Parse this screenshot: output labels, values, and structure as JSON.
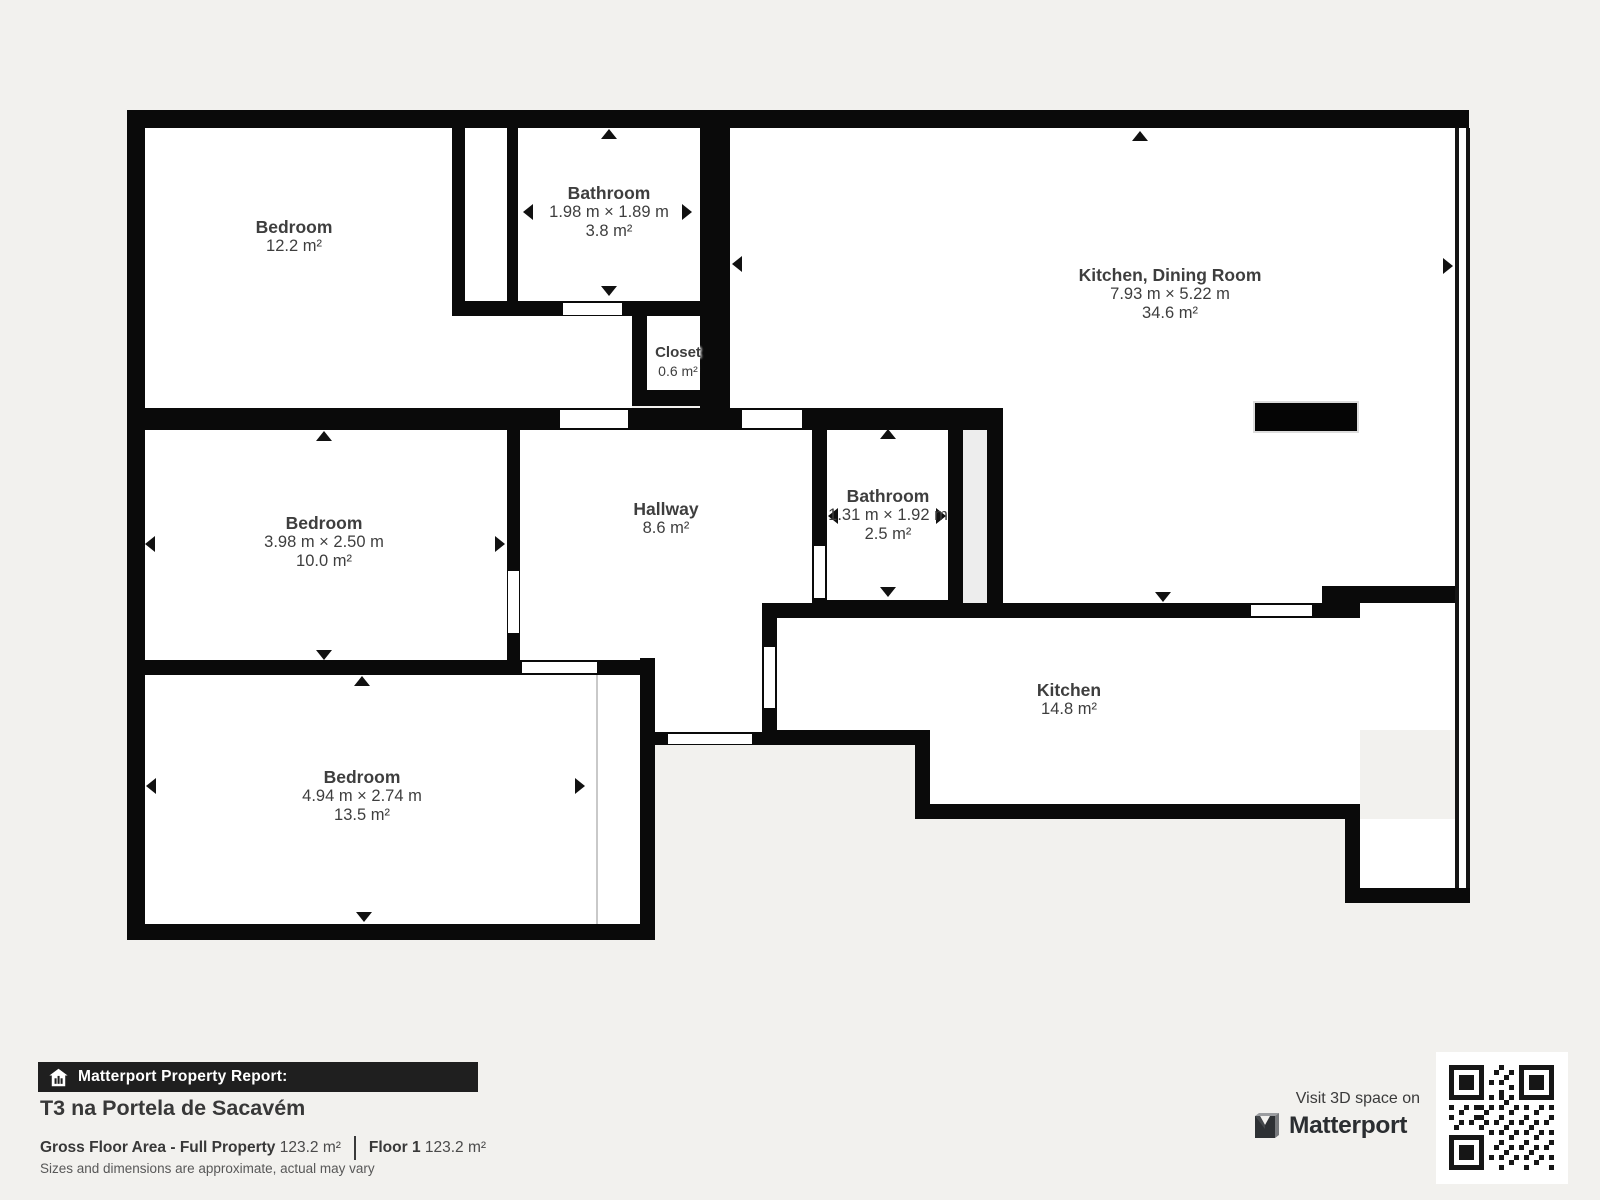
{
  "palette": {
    "background": "#f2f1ee",
    "wall": "#0a0a0a",
    "room_fill": "#ffffff",
    "label_text": "#3e3e3e",
    "bar_bg": "#1f1f1f",
    "brand_text": "#2b2e31"
  },
  "rooms": [
    {
      "id": "bedroom-top-left",
      "name": "Bedroom",
      "dims": "",
      "area": "12.2 m²"
    },
    {
      "id": "bathroom-top",
      "name": "Bathroom",
      "dims": "1.98 m × 1.89 m",
      "area": "3.8 m²"
    },
    {
      "id": "kitchen-dining",
      "name": "Kitchen, Dining Room",
      "dims": "7.93 m × 5.22 m",
      "area": "34.6 m²"
    },
    {
      "id": "closet",
      "name": "Closet",
      "dims": "",
      "area": "0.6 m²"
    },
    {
      "id": "bedroom-middle",
      "name": "Bedroom",
      "dims": "3.98 m × 2.50 m",
      "area": "10.0 m²"
    },
    {
      "id": "hallway",
      "name": "Hallway",
      "dims": "",
      "area": "8.6 m²"
    },
    {
      "id": "bathroom-middle",
      "name": "Bathroom",
      "dims": "1.31 m × 1.92 m",
      "area": "2.5 m²"
    },
    {
      "id": "kitchen",
      "name": "Kitchen",
      "dims": "",
      "area": "14.8 m²"
    },
    {
      "id": "bedroom-bottom",
      "name": "Bedroom",
      "dims": "4.94 m × 2.74 m",
      "area": "13.5 m²"
    }
  ],
  "footer": {
    "report_label": "Matterport Property Report:",
    "property_title": "T3 na Portela de Sacavém",
    "gfa_label": "Gross Floor Area - Full Property",
    "gfa_value": "123.2 m²",
    "floor_label": "Floor 1",
    "floor_value": "123.2 m²",
    "disclaimer": "Sizes and dimensions are approximate, actual may vary",
    "visit_label": "Visit 3D space on",
    "brand": "Matterport"
  }
}
